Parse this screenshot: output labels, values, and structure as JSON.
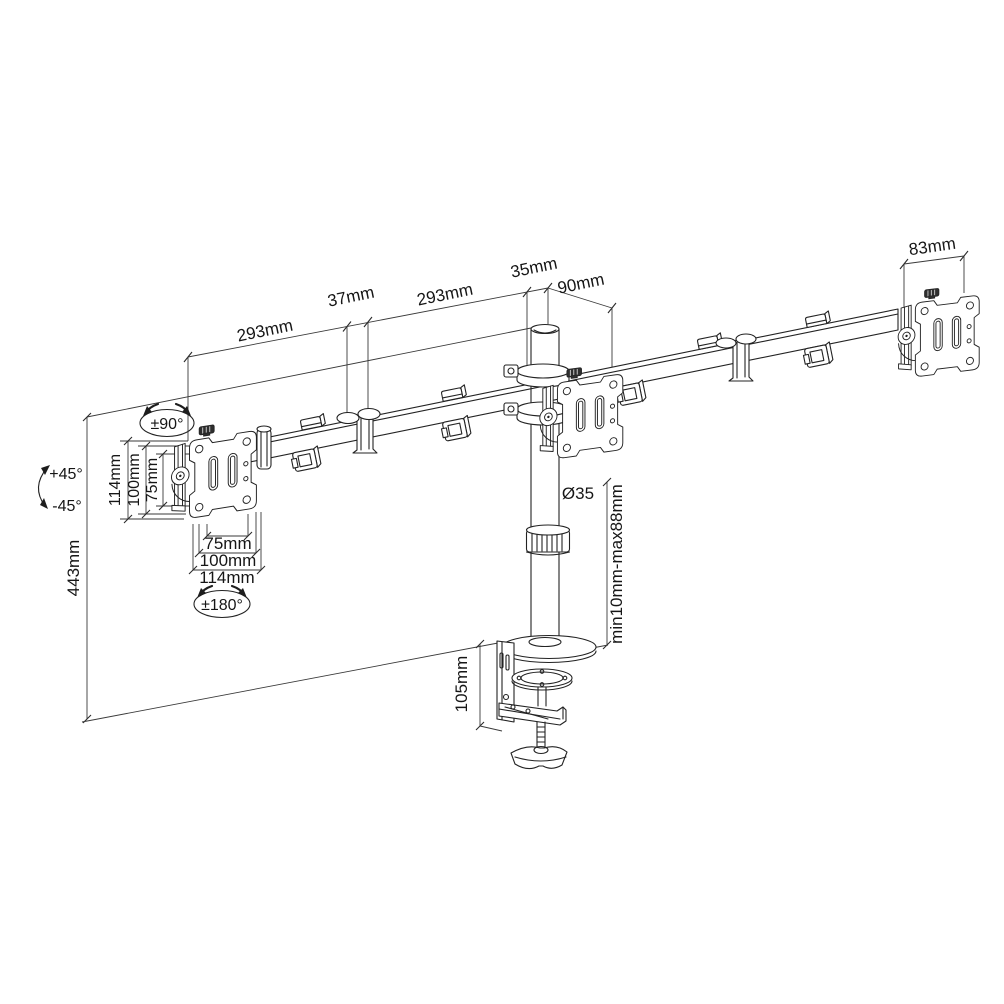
{
  "drawing": {
    "background": "#ffffff",
    "ink": "#232323",
    "labels": {
      "arm_left_length": "293mm",
      "mid_joint_width": "37mm",
      "arm_right_length": "293mm",
      "pole_cap_width": "35mm",
      "head_offset": "90mm",
      "plate_width": "83mm",
      "swivel_range": "±90°",
      "tilt_up": "+45°",
      "tilt_down": "-45°",
      "vesa_vertical": [
        "114mm",
        "100mm",
        "75mm"
      ],
      "vesa_horizontal": [
        "75mm",
        "100mm",
        "114mm"
      ],
      "rotation_range": "±180°",
      "column_height": "443mm",
      "pole_diameter": "Ø35",
      "clamp_thickness_range": "min10mm-max88mm",
      "clamp_height": "105mm"
    }
  }
}
